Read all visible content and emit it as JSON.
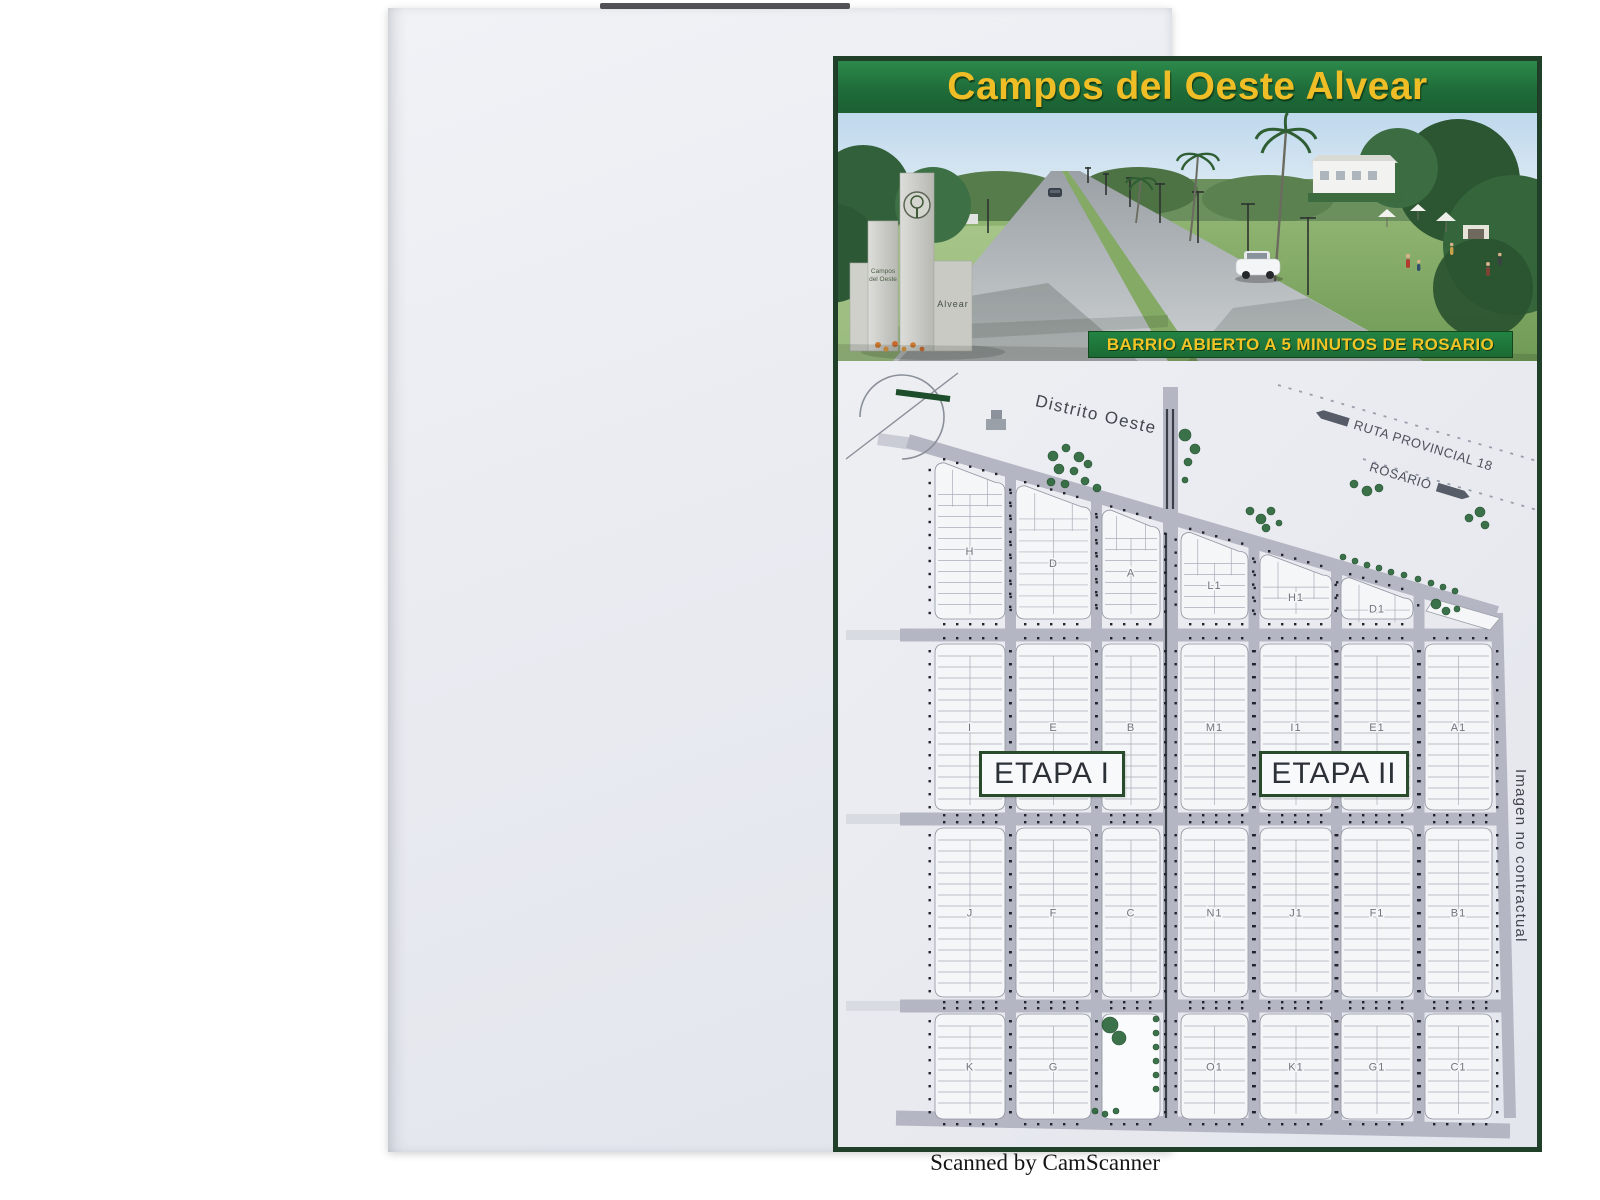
{
  "page": {
    "scan_credit": "Scanned by CamScanner"
  },
  "flyer": {
    "title": "Campos del Oeste Alvear",
    "tagline": "BARRIO ABIERTO A 5 MINUTOS DE ROSARIO",
    "photo": {
      "monument_line1": "Campos",
      "monument_line2": "del Oeste",
      "monument_name": "Alvear"
    }
  },
  "map": {
    "district_label": "Distrito Oeste",
    "route_label": "RUTA PROVINCIAL 18",
    "rosario_label": "ROSARIO",
    "stage1_label": "ETAPA I",
    "stage2_label": "ETAPA II",
    "disclaimer": "Imagen no contractual",
    "blocks": [
      {
        "label": "H",
        "col": 0,
        "row": 1
      },
      {
        "label": "D",
        "col": 1,
        "row": 1
      },
      {
        "label": "A",
        "col": 2,
        "row": 1
      },
      {
        "label": "L1",
        "col": 3,
        "row": 1
      },
      {
        "label": "H1",
        "col": 4,
        "row": 1
      },
      {
        "label": "D1",
        "col": 5,
        "row": 1
      },
      {
        "label": "I",
        "col": 0,
        "row": 2
      },
      {
        "label": "E",
        "col": 1,
        "row": 2
      },
      {
        "label": "B",
        "col": 2,
        "row": 2
      },
      {
        "label": "M1",
        "col": 3,
        "row": 2
      },
      {
        "label": "I1",
        "col": 4,
        "row": 2
      },
      {
        "label": "E1",
        "col": 5,
        "row": 2
      },
      {
        "label": "A1",
        "col": 6,
        "row": 2
      },
      {
        "label": "J",
        "col": 0,
        "row": 3
      },
      {
        "label": "F",
        "col": 1,
        "row": 3
      },
      {
        "label": "C",
        "col": 2,
        "row": 3
      },
      {
        "label": "N1",
        "col": 3,
        "row": 3
      },
      {
        "label": "J1",
        "col": 4,
        "row": 3
      },
      {
        "label": "F1",
        "col": 5,
        "row": 3
      },
      {
        "label": "B1",
        "col": 6,
        "row": 3
      },
      {
        "label": "K",
        "col": 0,
        "row": 4
      },
      {
        "label": "G",
        "col": 1,
        "row": 4
      },
      {
        "label": "",
        "col": 2,
        "row": 4,
        "park": true
      },
      {
        "label": "O1",
        "col": 3,
        "row": 4
      },
      {
        "label": "K1",
        "col": 4,
        "row": 4
      },
      {
        "label": "G1",
        "col": 5,
        "row": 4
      },
      {
        "label": "C1",
        "col": 6,
        "row": 4
      }
    ],
    "trees": [
      [
        215,
        95,
        5
      ],
      [
        228,
        87,
        4
      ],
      [
        241,
        96,
        5
      ],
      [
        221,
        108,
        5
      ],
      [
        236,
        110,
        4
      ],
      [
        250,
        103,
        4
      ],
      [
        213,
        121,
        4
      ],
      [
        227,
        123,
        4
      ],
      [
        247,
        120,
        4
      ],
      [
        259,
        127,
        4
      ],
      [
        347,
        74,
        6
      ],
      [
        357,
        88,
        5
      ],
      [
        350,
        101,
        4
      ],
      [
        347,
        119,
        3
      ],
      [
        412,
        150,
        4
      ],
      [
        423,
        158,
        5
      ],
      [
        433,
        150,
        4
      ],
      [
        428,
        167,
        4
      ],
      [
        441,
        162,
        3
      ],
      [
        516,
        123,
        4
      ],
      [
        529,
        130,
        5
      ],
      [
        541,
        127,
        4
      ],
      [
        505,
        196,
        3
      ],
      [
        517,
        200,
        3
      ],
      [
        529,
        204,
        3
      ],
      [
        541,
        207,
        3
      ],
      [
        553,
        211,
        3
      ],
      [
        566,
        214,
        3
      ],
      [
        580,
        218,
        3
      ],
      [
        593,
        222,
        3
      ],
      [
        605,
        226,
        3
      ],
      [
        617,
        230,
        3
      ],
      [
        631,
        157,
        4
      ],
      [
        642,
        151,
        5
      ],
      [
        647,
        164,
        4
      ],
      [
        598,
        243,
        5
      ],
      [
        608,
        250,
        4
      ],
      [
        619,
        248,
        3
      ],
      [
        272,
        664,
        8
      ],
      [
        281,
        677,
        7
      ],
      [
        318,
        658,
        3
      ],
      [
        318,
        672,
        3
      ],
      [
        318,
        686,
        3
      ],
      [
        318,
        700,
        3
      ],
      [
        318,
        714,
        3
      ],
      [
        318,
        728,
        3
      ],
      [
        257,
        750,
        3
      ],
      [
        267,
        753,
        3
      ],
      [
        278,
        750,
        3
      ]
    ]
  },
  "colors": {
    "frame_green": "#21402a",
    "banner_green": "#1f6d3a",
    "title_yellow": "#efbe26",
    "road_grey": "#b5b6c3",
    "block_fill": "#f5f6f8",
    "parcel_line": "#a9adb9",
    "dot": "#20232b",
    "tree_green": "#316b40",
    "stage_border": "#2a4a2c",
    "divider_dark": "#3a4047"
  }
}
